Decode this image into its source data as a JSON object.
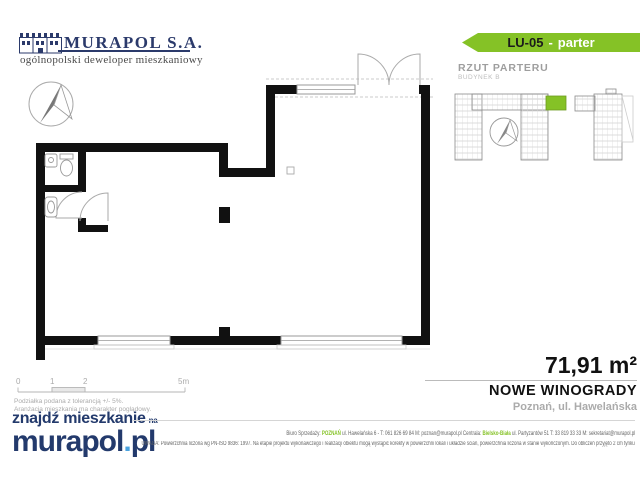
{
  "colors": {
    "green": "#85c226",
    "navy": "#233a6c"
  },
  "logo": {
    "company": "MURAPOL S.A.",
    "tagline": "ogólnopolski deweloper mieszkaniowy"
  },
  "banner": {
    "unit": "LU-05",
    "separator": "-",
    "floor": "parter"
  },
  "overview": {
    "title": "RZUT PARTERU",
    "subtitle": "BUDYNEK B"
  },
  "unit": {
    "area": "71,91 m²",
    "development": "NOWE WINOGRADY",
    "address": "Poznań, ul. Hawelańska"
  },
  "scalebar": {
    "ticks": [
      "0",
      "1",
      "2",
      "5m"
    ],
    "note1": "Podziałka podana z tolerancją +/- 5%.",
    "note2": "Aranżacja mieszkania ma charakter poglądowy."
  },
  "brand": {
    "find_text": "znajdź mieszkanie",
    "find_suffix": "na",
    "domain_name": "murapol",
    "domain_dot": ".",
    "domain_tld": "pl"
  },
  "footer": {
    "sales_label": "Biuro Sprzedaży:",
    "sales_city": "POZNAŃ",
    "sales_rest": "ul. Hawelańska 6 - T: 061 826 69 84 M: poznan@murapol.pl",
    "hq_label": "Centrala:",
    "hq_city": "Bielsko-Biała",
    "hq_rest": "ul. Partyzantów 51 T: 33 819 33 33 M: sekretariat@murapol.pl",
    "note": "UWAGA: Powierzchnia liczona wg PN-ISO 9836: 1997. Na etapie projektu wykonawczego i realizacji obiektu mogą wystąpić korekty w powierzchni lokali i układzie ścian, powierzchnia liczona w stanie wykończonym. Do obliczeń przyjęto 2 cm tynku"
  }
}
